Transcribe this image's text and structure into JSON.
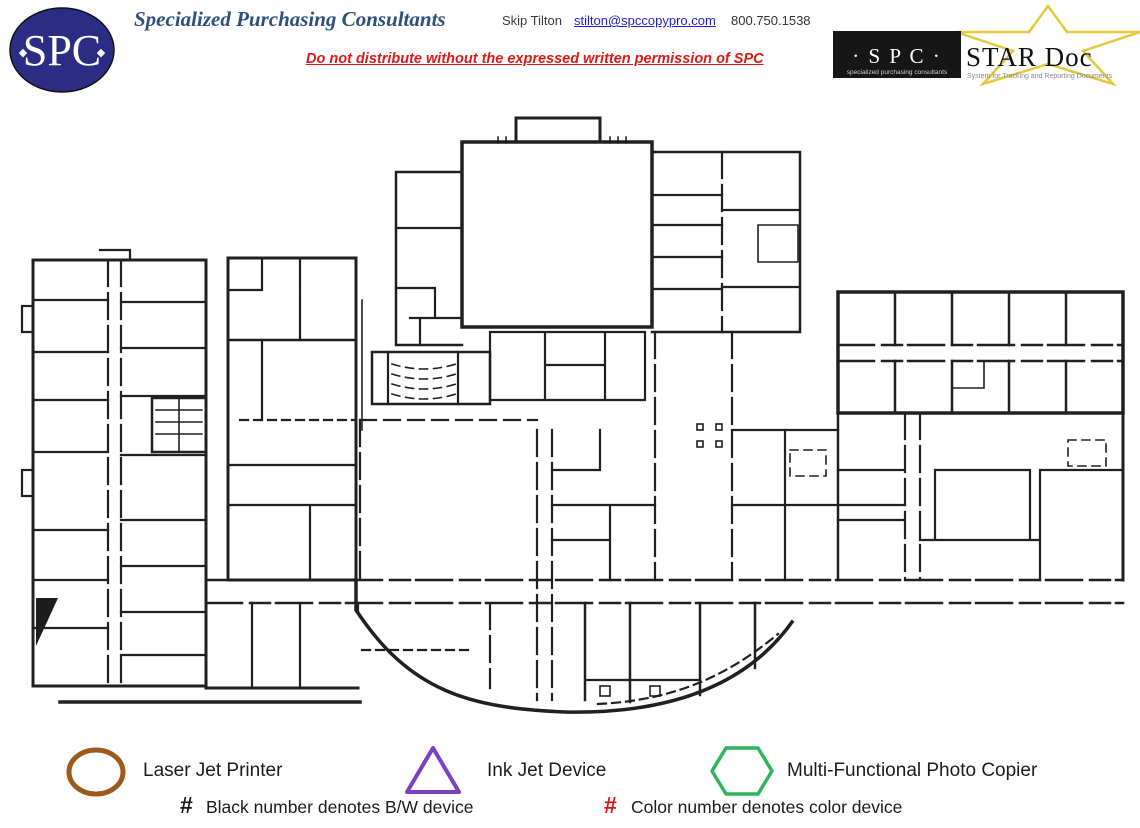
{
  "header": {
    "logo": {
      "text": "SPC",
      "bg_color": "#2b2d84"
    },
    "company": "Specialized Purchasing Consultants",
    "contact_name": "Skip Tilton",
    "email": "stilton@spccopypro.com",
    "phone": "800.750.1538",
    "notice": "Do not distribute without the expressed written permission of SPC"
  },
  "star_logo": {
    "spc_text": "· S P C ·",
    "spc_subtext": "specialized purchasing consultants",
    "product_name": "STAR Doc",
    "product_subtext": "System for Tracking and Reporting Documents",
    "star_color": "#e2c93d"
  },
  "floor_plan": {
    "alt": "Scanned black-and-white architectural floor plan of a school building with left wing, central hall, right classroom grid and curved cafeteria wall"
  },
  "legend": {
    "devices": [
      {
        "shape": "ellipse",
        "color": "#9c5a1c",
        "label": "Laser Jet Printer"
      },
      {
        "shape": "triangle",
        "color": "#7d3fc1",
        "label": "Ink Jet Device"
      },
      {
        "shape": "hexagon",
        "color": "#2eb45d",
        "label": "Multi-Functional Photo Copier"
      }
    ],
    "notes": [
      {
        "symbol": "#",
        "color": "#1a1a1a",
        "text": "Black number denotes B/W device"
      },
      {
        "symbol": "#",
        "color": "#e01010",
        "text": "Color number denotes color device"
      }
    ]
  }
}
